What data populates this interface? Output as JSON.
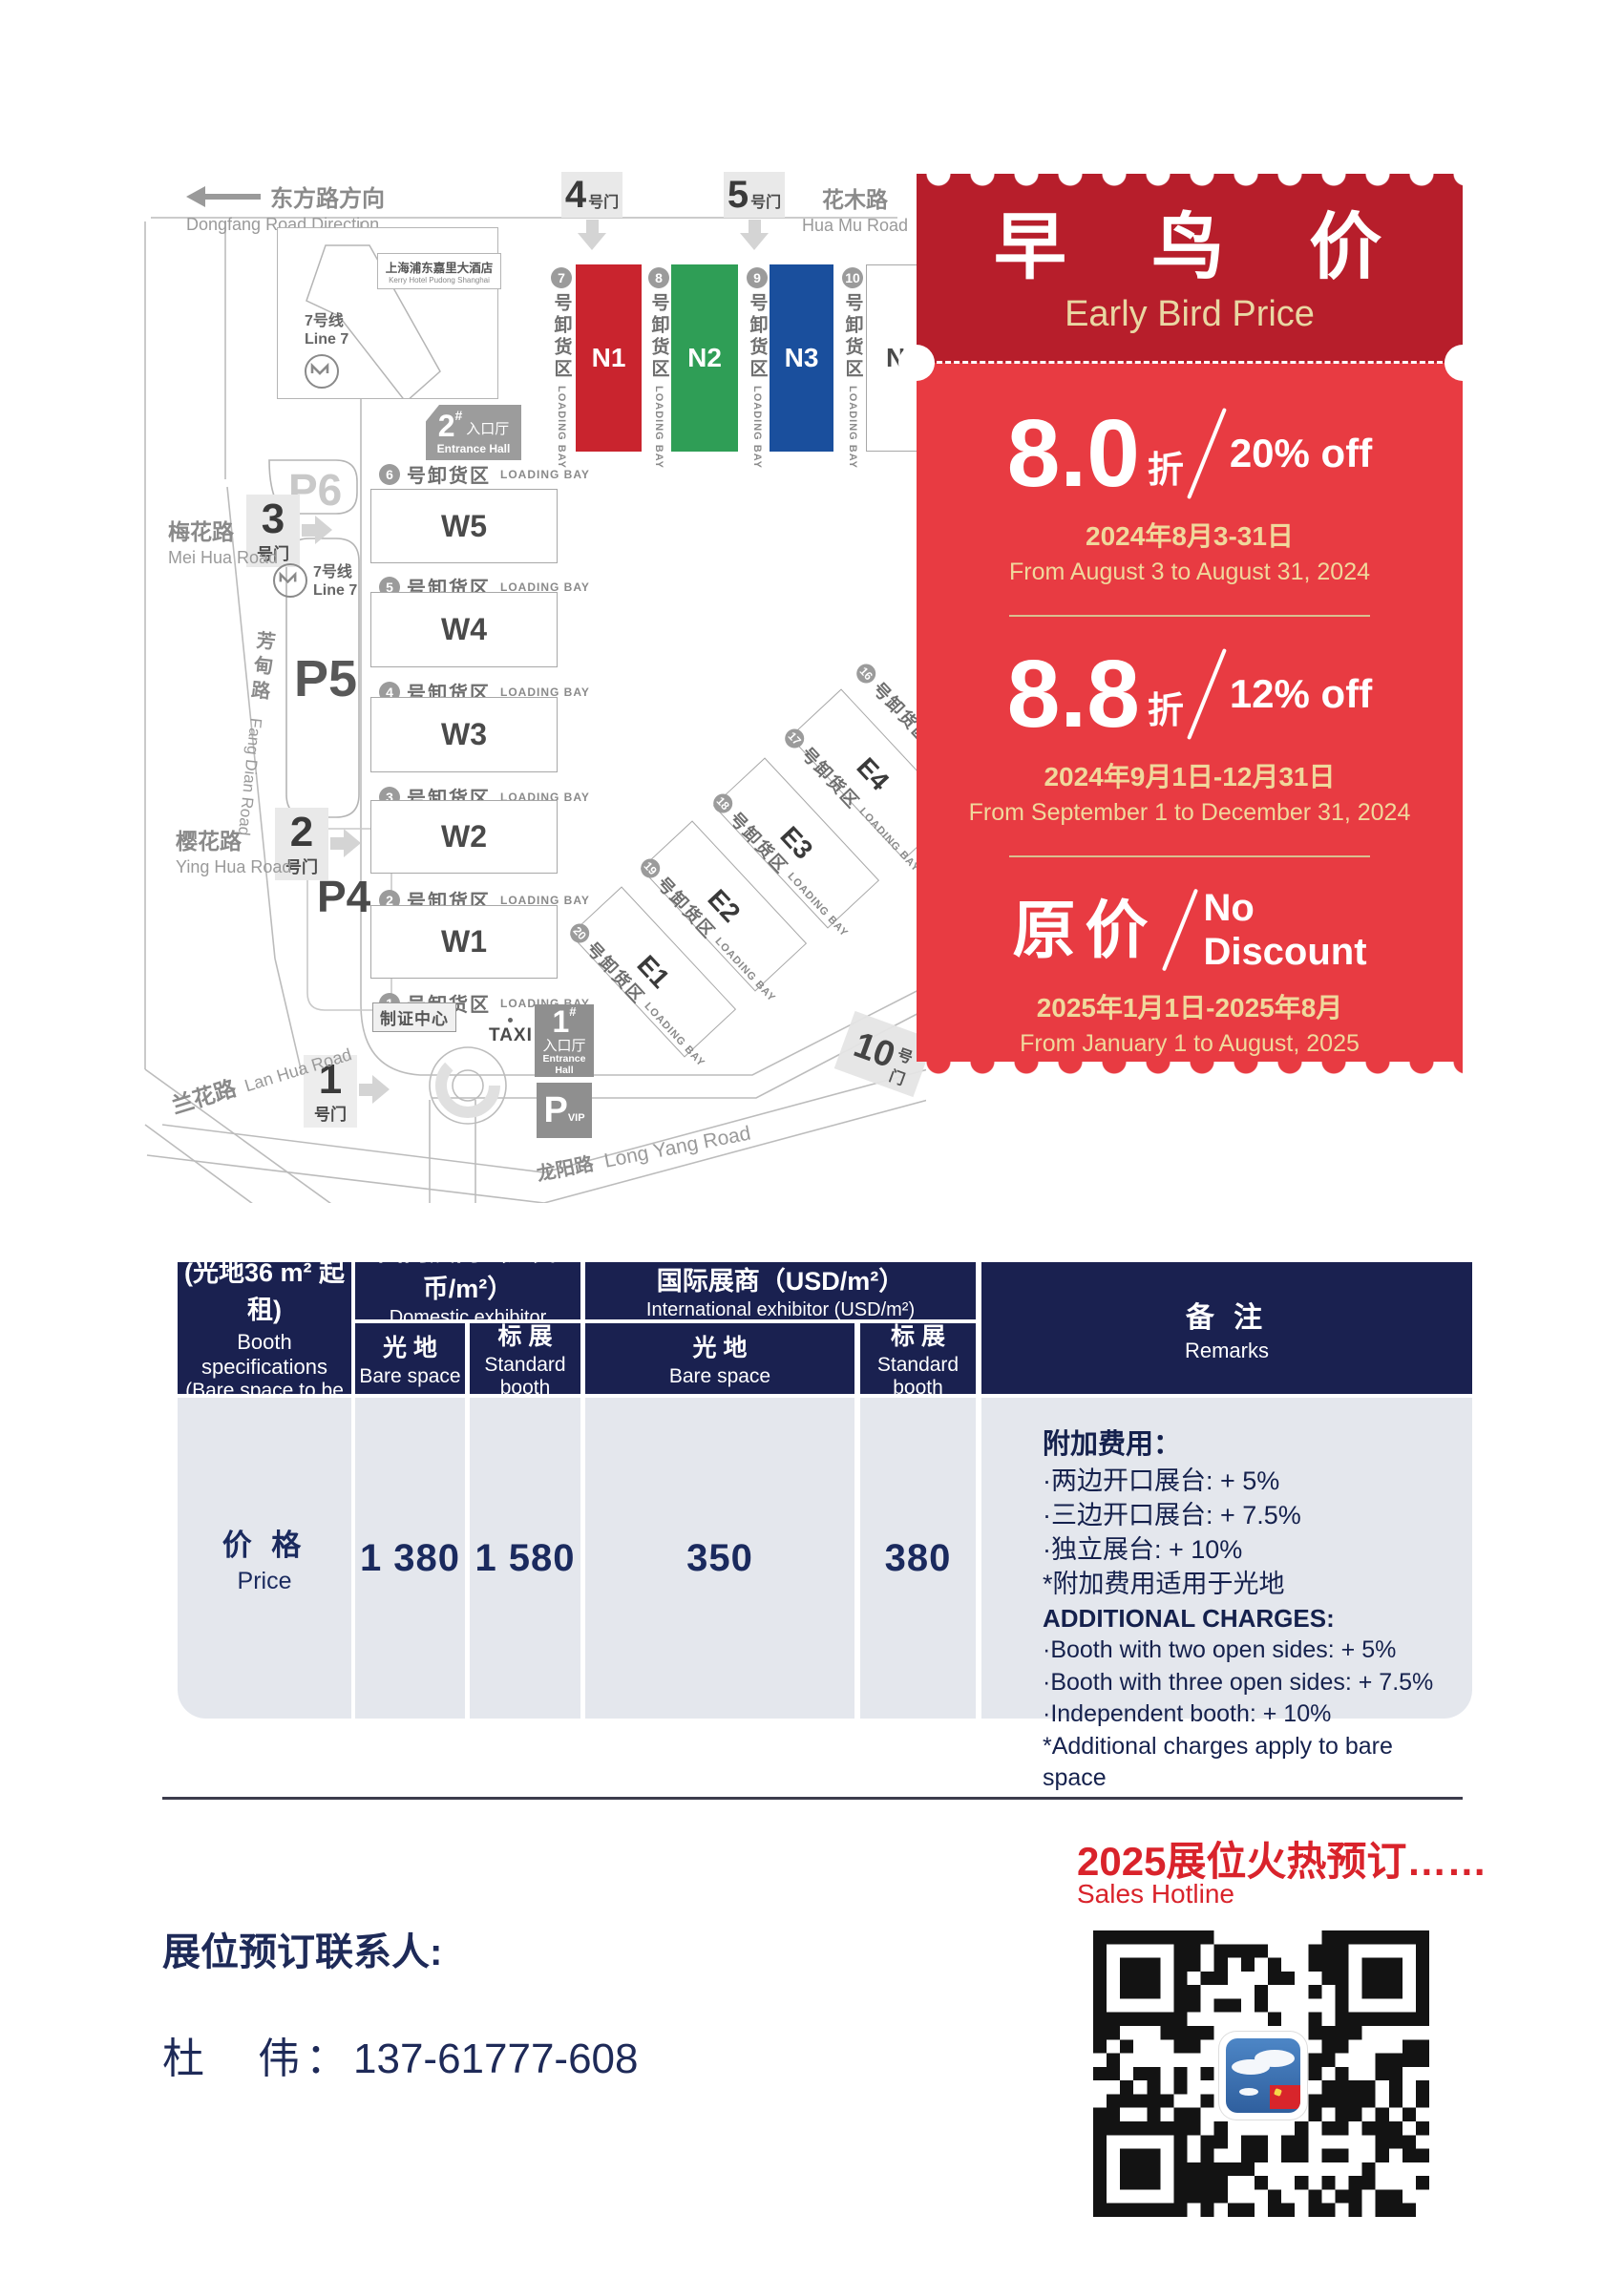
{
  "map": {
    "direction": {
      "zh": "东方路方向",
      "en": "Dongfang Road Direction"
    },
    "roads": {
      "huamu": {
        "zh": "花木路",
        "en": "Hua Mu Road"
      },
      "meihua": {
        "zh": "梅花路",
        "en": "Mei Hua Road"
      },
      "fangdian": {
        "zh": "芳甸路",
        "en": "Fang Dian Road"
      },
      "yinghua": {
        "zh": "樱花路",
        "en": "Ying Hua Road"
      },
      "lanhua": {
        "zh": "兰花路",
        "en": "Lan Hua Road"
      },
      "longyang": {
        "zh": "龙阳路",
        "en": "Long Yang Road"
      }
    },
    "hotel": {
      "zh": "上海浦东嘉里大酒店",
      "en": "Kerry Hotel Pudong Shanghai"
    },
    "metro": {
      "zh": "7号线",
      "en": "Line 7"
    },
    "gates": {
      "g1": {
        "num": "1",
        "label": "号门"
      },
      "g2": {
        "num": "2",
        "label": "号门"
      },
      "g3": {
        "num": "3",
        "label": "号门"
      },
      "g4": {
        "num": "4",
        "label": "号门"
      },
      "g5": {
        "num": "5",
        "label": "号门"
      },
      "g10": {
        "num": "10",
        "label": "号门"
      }
    },
    "entrance1": {
      "num": "1",
      "hash": "#",
      "zh": "入口厅",
      "en": "Entrance Hall"
    },
    "entrance2": {
      "num": "2",
      "hash": "#",
      "zh": "入口厅",
      "en": "Entrance Hall"
    },
    "badge_center": "制证中心",
    "taxi": "TAXI",
    "parking": {
      "p4": "P4",
      "p5": "P5",
      "p6": "P6",
      "pvip_p": "P",
      "pvip_sub": "VIP"
    },
    "halls": {
      "n": [
        {
          "label": "N1",
          "color": "#c9242e"
        },
        {
          "label": "N2",
          "color": "#2f9e56"
        },
        {
          "label": "N3",
          "color": "#1a4f9d"
        },
        {
          "label": "N4",
          "color": "#ffffff"
        }
      ],
      "w": [
        "W5",
        "W4",
        "W3",
        "W2",
        "W1"
      ],
      "e": [
        "E1",
        "E2",
        "E3",
        "E4"
      ]
    },
    "loading_bay": {
      "zh": "号卸货区",
      "en": "LOADING BAY",
      "vertical_nums": [
        "7",
        "8",
        "9",
        "10"
      ],
      "horizontal_nums": [
        "6",
        "5",
        "4",
        "3",
        "2",
        "1"
      ],
      "diagonal_nums": [
        "20",
        "19",
        "18",
        "17",
        "16"
      ]
    }
  },
  "coupon": {
    "title_zh": "早 鸟 价",
    "title_en": "Early Bird Price",
    "tiers": [
      {
        "big": "8.0",
        "unit": "折",
        "off": "20% off",
        "date_zh": "2024年8月3-31日",
        "date_en": "From August 3 to August 31, 2024"
      },
      {
        "big": "8.8",
        "unit": "折",
        "off": "12% off",
        "date_zh": "2024年9月1日-12月31日",
        "date_en": "From September 1 to December 31, 2024"
      },
      {
        "big": "原价",
        "off_line1": "No",
        "off_line2": "Discount",
        "date_zh": "2025年1月1日-2025年8月",
        "date_en": "From January 1 to August, 2025"
      }
    ]
  },
  "table": {
    "col1": {
      "zh1": "展位规格",
      "zh2": "(光地36 m² 起租)",
      "en1": "Booth specifications",
      "en2": "(Bare space to be rented",
      "en3": "from 36 m²)"
    },
    "domestic": {
      "zh": "国内展商（人民币/m²）",
      "en": "Domestic exhibitor (RMB/m²)"
    },
    "international": {
      "zh": "国际展商（USD/m²）",
      "en": "International exhibitor (USD/m²)"
    },
    "sub_bare": {
      "zh": "光 地",
      "en": "Bare space"
    },
    "sub_std": {
      "zh": "标 展",
      "en": "Standard booth"
    },
    "remarks_head": {
      "zh": "备 注",
      "en": "Remarks"
    },
    "price_row": {
      "zh": "价 格",
      "en": "Price"
    },
    "values": [
      "1 380",
      "1 580",
      "350",
      "380"
    ],
    "remarks_cn": [
      "附加费用：",
      "·两边开口展台: + 5%",
      "·三边开口展台: + 7.5%",
      "·独立展台: + 10%",
      "*附加费用适用于光地"
    ],
    "remarks_en": [
      "ADDITIONAL CHARGES:",
      "·Booth with two open sides: + 5%",
      "·Booth with three open sides: + 7.5%",
      "·Independent booth: + 10%",
      "*Additional charges apply to bare space"
    ]
  },
  "footer": {
    "hotline_zh": "2025展位火热预订……",
    "hotline_en": "Sales Hotline",
    "contact_label": "展位预订联系人:",
    "contact_name": "杜　伟：",
    "contact_phone": "137-61777-608"
  },
  "colors": {
    "coupon_header_red": "#b71e2b",
    "coupon_body_red": "#e83b42",
    "gold": "#e9d7a3",
    "table_navy": "#1a2150",
    "table_body_gray": "#e4e7ed",
    "accent_red": "#d9232b",
    "hall_n1_red": "#c9242e",
    "hall_n2_green": "#2f9e56",
    "hall_n3_blue": "#1a4f9d"
  }
}
